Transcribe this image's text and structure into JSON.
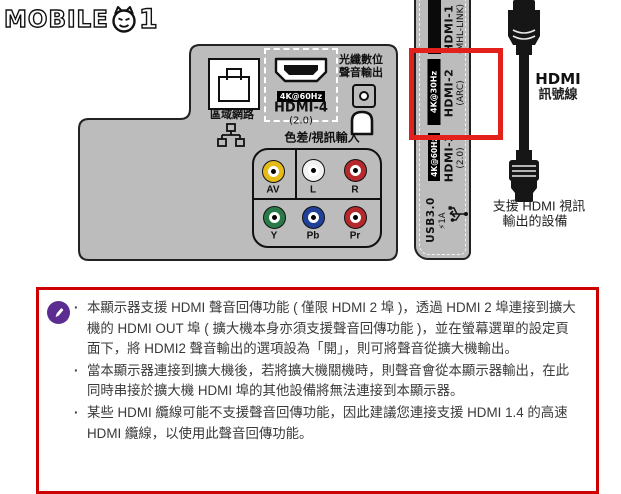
{
  "logo": {
    "brand": "MOBILE",
    "suffix": "1"
  },
  "rear_panel": {
    "lan": {
      "label": "區域網路"
    },
    "hdmi4": {
      "badge": "4K@60Hz",
      "name": "HDMI-4",
      "version": "(2.0)"
    },
    "optical": {
      "label_line1": "光纖數位",
      "label_line2": "聲音輸出"
    },
    "component_title": "色差/視訊輸入",
    "jacks": [
      {
        "label": "AV",
        "color": "#e5bb17"
      },
      {
        "label": "L",
        "color": "#f2f2f2"
      },
      {
        "label": "R",
        "color": "#b5282c"
      },
      {
        "label": "Y",
        "color": "#2a7a49"
      },
      {
        "label": "Pb",
        "color": "#20409a"
      },
      {
        "label": "Pr",
        "color": "#b5282c"
      }
    ]
  },
  "side_panel": {
    "hdmi1": {
      "name": "HDMI-1",
      "sub": "(MHL-LINK)"
    },
    "hdmi2": {
      "name": "HDMI-2",
      "sub": "(ARC)",
      "badge": "4K@30Hz"
    },
    "hdmi3": {
      "name": "HDMI-3",
      "sub": "(2.0)",
      "badge": "4K@60Hz"
    },
    "usb": {
      "name": "USB3.0",
      "sub": "⚡1A"
    }
  },
  "cable": {
    "label_line1": "HDMI",
    "label_line2": "訊號線",
    "device_label_line1": "支援 HDMI 視訊",
    "device_label_line2": "輸出的設備"
  },
  "note_box": {
    "bullets": [
      "本顯示器支援 HDMI 聲音回傳功能 ( 僅限 HDMI 2 埠 )，透過 HDMI 2 埠連接到擴大機的 HDMI OUT 埠 ( 擴大機本身亦須支援聲音回傳功能 )，並在螢幕選單的設定頁面下，將 HDMI2 聲音輸出的選項設為「開」，則可將聲音從擴大機輸出。",
      "當本顯示器連接到擴大機後，若將擴大機關機時，則聲音會從本顯示器輸出，在此同時串接於擴大機 HDMI 埠的其他設備將無法連接到本顯示器。",
      "某些 HDMI 纜線可能不支援聲音回傳功能，因此建議您連接支援 HDMI 1.4 的高速 HDMI 纜線，以使用此聲音回傳功能。"
    ]
  },
  "colors": {
    "panel_gray": "#bcbcbc",
    "highlight_red": "#e2211c",
    "note_border_red": "#cc0000",
    "note_icon_purple": "#5b2d90",
    "badge_bg": "#000000"
  }
}
